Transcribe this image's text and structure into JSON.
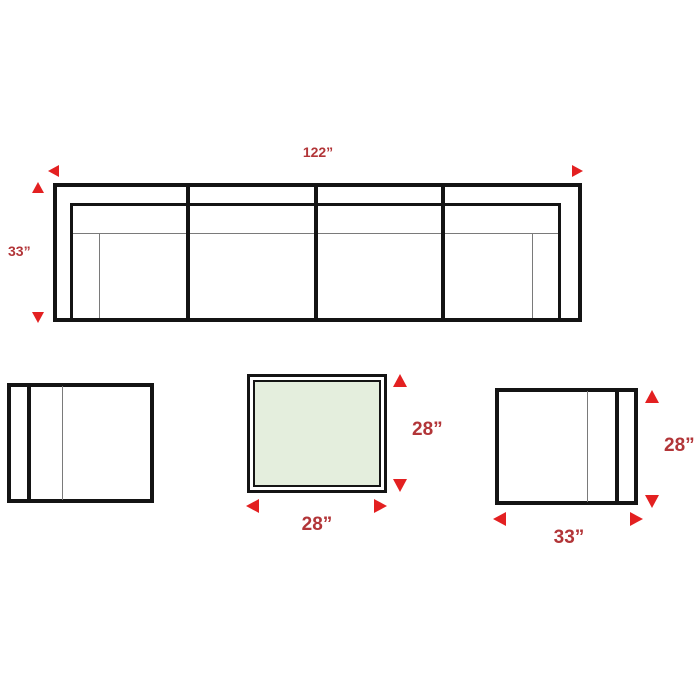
{
  "colors": {
    "arrow_red": "#e32021",
    "label_red": "#b23538",
    "outline_black": "#141414",
    "table_glass_green": "#e4eedd",
    "background_white": "#ffffff"
  },
  "sofa": {
    "width": "122”",
    "depth": "33”"
  },
  "coffee_table": {
    "width": "28”",
    "depth": "28”"
  },
  "club_chair": {
    "width": "33”",
    "depth": "28”"
  }
}
